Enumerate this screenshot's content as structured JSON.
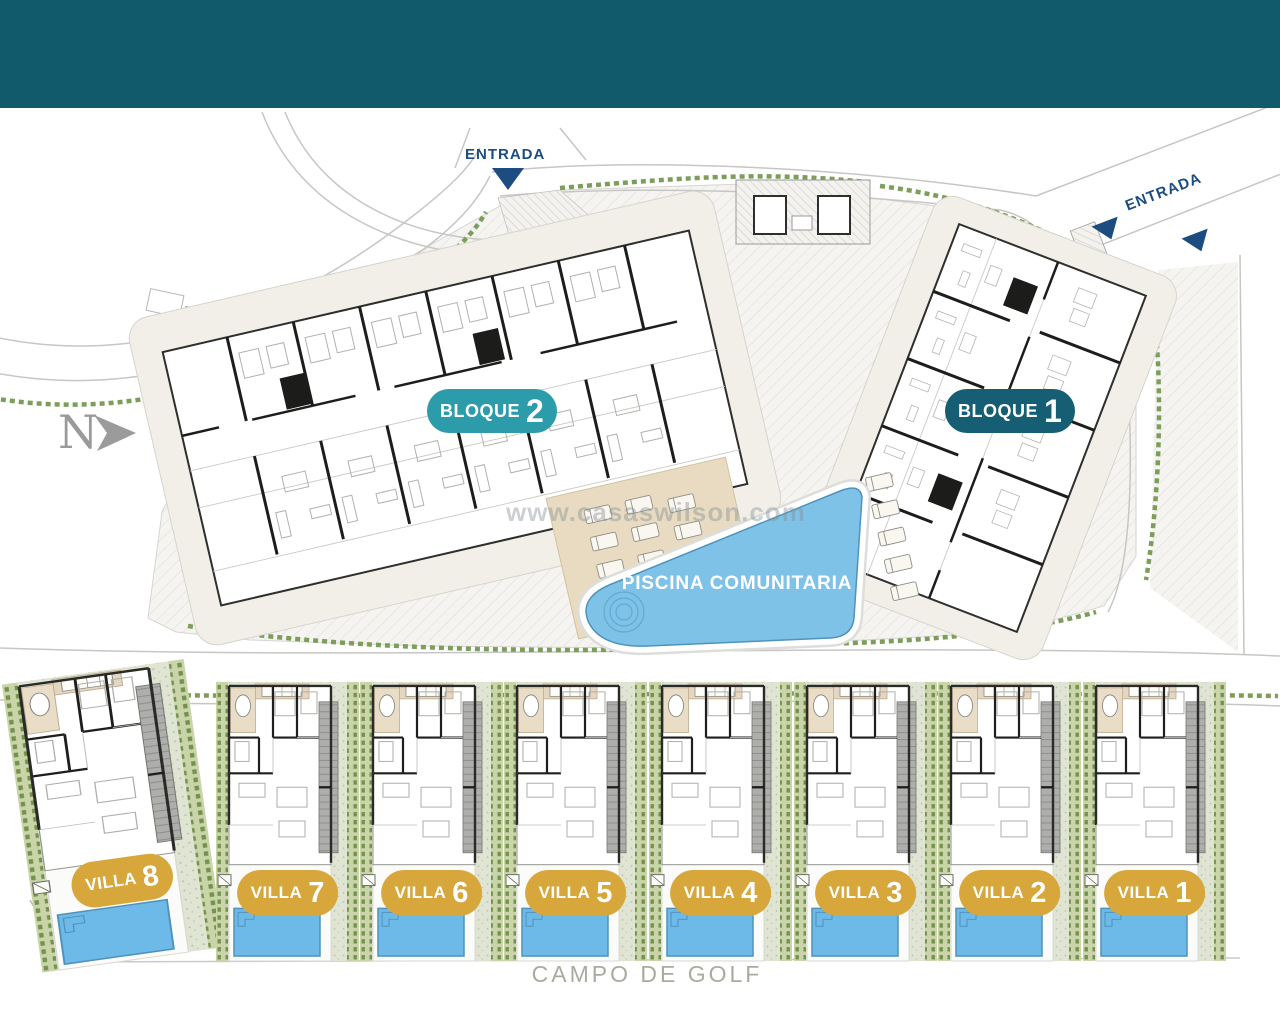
{
  "colors": {
    "header_band": "#115a6c",
    "bloque_2_badge": "#2d9caa",
    "bloque_1_badge": "#155e74",
    "villa_badge": "#d7a73c",
    "pool_water": "#7fc2e8",
    "entrance_navy": "#1d4d80",
    "hedge_green": "#7d9e5a"
  },
  "north": {
    "label": "N"
  },
  "entrances": {
    "left": {
      "label": "ENTRADA"
    },
    "right": {
      "label": "ENTRADA"
    }
  },
  "blocks": [
    {
      "label": "BLOQUE",
      "number": "2"
    },
    {
      "label": "BLOQUE",
      "number": "1"
    }
  ],
  "pool": {
    "label": "PISCINA COMUNITARIA"
  },
  "villas": [
    {
      "label": "VILLA",
      "number": "8"
    },
    {
      "label": "VILLA",
      "number": "7"
    },
    {
      "label": "VILLA",
      "number": "6"
    },
    {
      "label": "VILLA",
      "number": "5"
    },
    {
      "label": "VILLA",
      "number": "4"
    },
    {
      "label": "VILLA",
      "number": "3"
    },
    {
      "label": "VILLA",
      "number": "2"
    },
    {
      "label": "VILLA",
      "number": "1"
    }
  ],
  "golf": {
    "label": "CAMPO DE GOLF"
  },
  "watermark": {
    "text": "www.casaswilson.com"
  }
}
